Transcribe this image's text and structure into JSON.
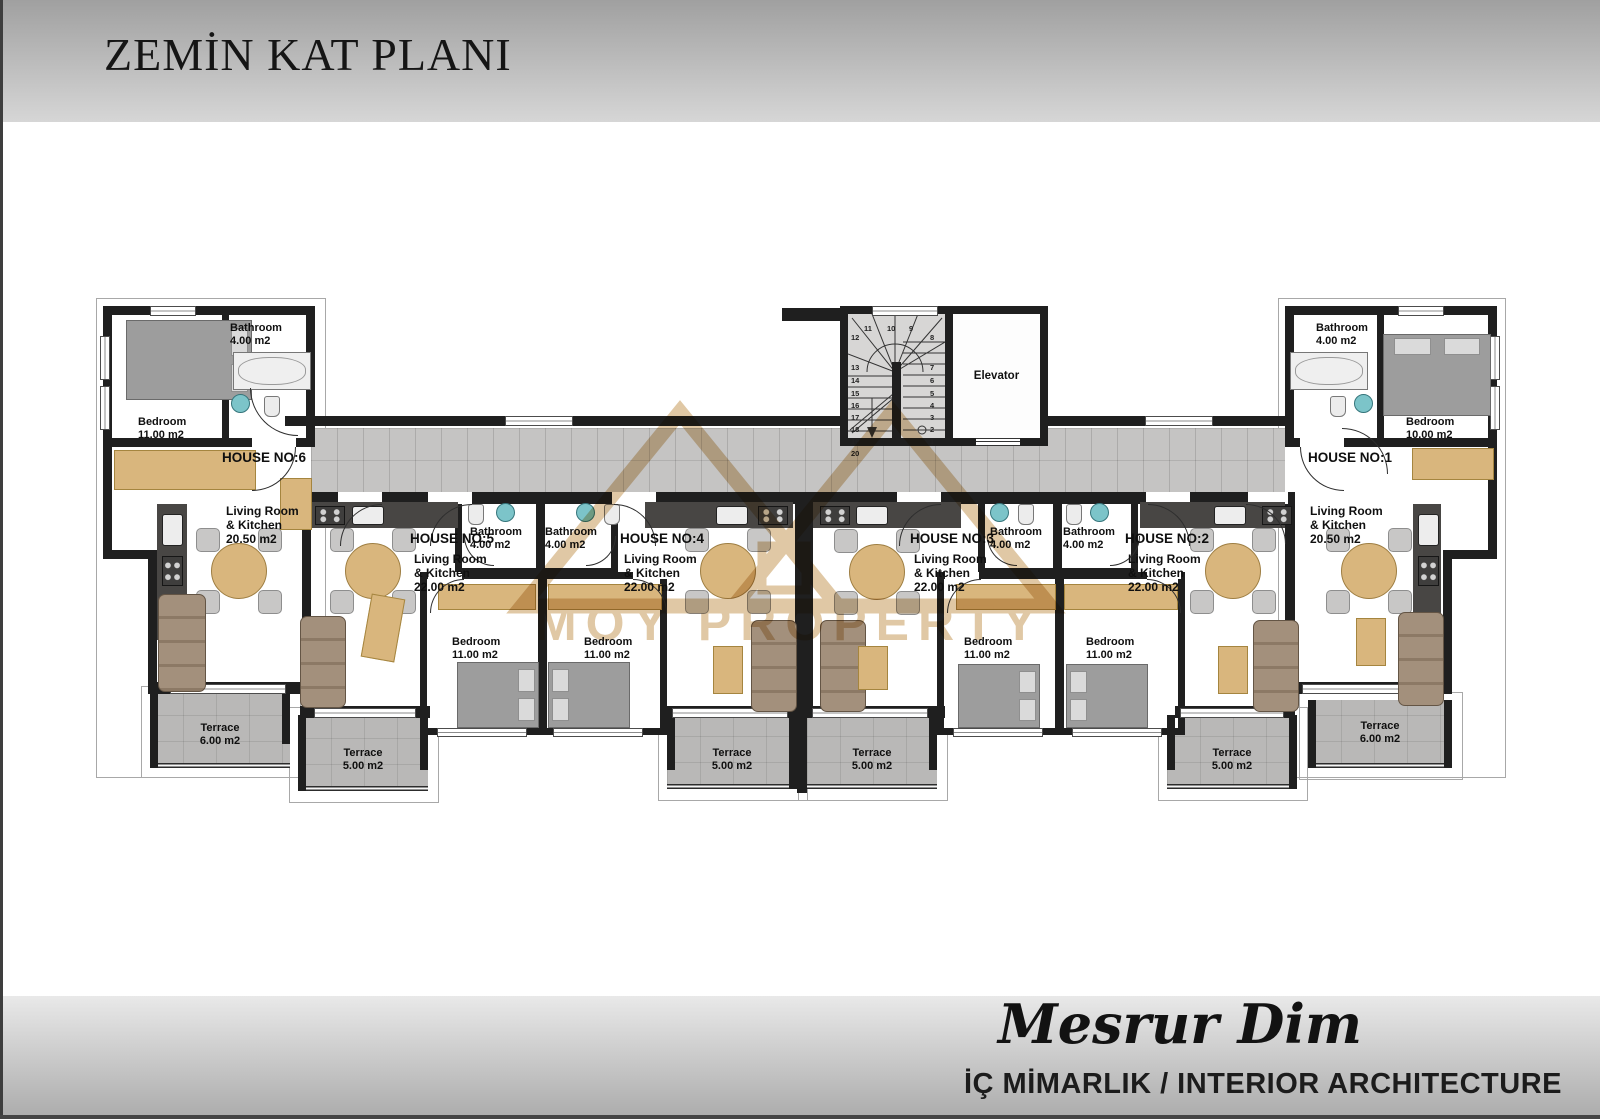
{
  "header": {
    "title": "ZEMİN KAT PLANI"
  },
  "footer": {
    "signature": "Mesrur Dim",
    "subtitle": "İÇ MİMARLIK / INTERIOR ARCHITECTURE"
  },
  "watermark": {
    "text": "MOY PROPERTY"
  },
  "core": {
    "elevator_label": "Elevator",
    "stairs": {
      "left_column": [
        "12",
        "13",
        "14",
        "15",
        "16",
        "17",
        "18",
        "19",
        "20"
      ],
      "top_row": [
        "11",
        "10",
        "9"
      ],
      "right_column": [
        "8",
        "7",
        "6",
        "5",
        "4",
        "3",
        "2",
        "1"
      ]
    }
  },
  "houses": {
    "h1": {
      "label": "HOUSE NO:1",
      "living": "Living Room\n& Kitchen\n20.50 m2",
      "bedroom": "Bedroom\n10.00 m2",
      "bathroom": "Bathroom\n4.00 m2",
      "terrace": "Terrace\n6.00 m2"
    },
    "h2": {
      "label": "HOUSE NO:2",
      "living": "Living Room\n& Kitchen\n22.00 m2",
      "bedroom": "Bedroom\n11.00 m2",
      "bathroom": "Bathroom\n4.00 m2",
      "terrace": "Terrace\n5.00 m2"
    },
    "h3": {
      "label": "HOUSE NO:3",
      "living": "Living Room\n& Kitchen\n22.00 m2",
      "bedroom": "Bedroom\n11.00 m2",
      "bathroom": "Bathroom\n4.00 m2",
      "terrace": "Terrace\n5.00 m2"
    },
    "h4": {
      "label": "HOUSE NO:4",
      "living": "Living Room\n& Kitchen\n22.00 m2",
      "bedroom": "Bedroom\n11.00 m2",
      "bathroom": "Bathroom\n4.00 m2",
      "terrace": "Terrace\n5.00 m2"
    },
    "h5": {
      "label": "HOUSE NO:5",
      "living": "Living Room\n& Kitchen\n22.00 m2",
      "bedroom": "Bedroom\n11.00 m2",
      "bathroom": "Bathroom\n4.00 m2",
      "terrace": "Terrace\n5.00 m2"
    },
    "h6": {
      "label": "HOUSE NO:6",
      "living": "Living Room\n& Kitchen\n20.50 m2",
      "bedroom": "Bedroom\n11.00 m2",
      "bathroom": "Bathroom\n4.00 m2",
      "terrace": "Terrace\n6.00 m2"
    }
  }
}
